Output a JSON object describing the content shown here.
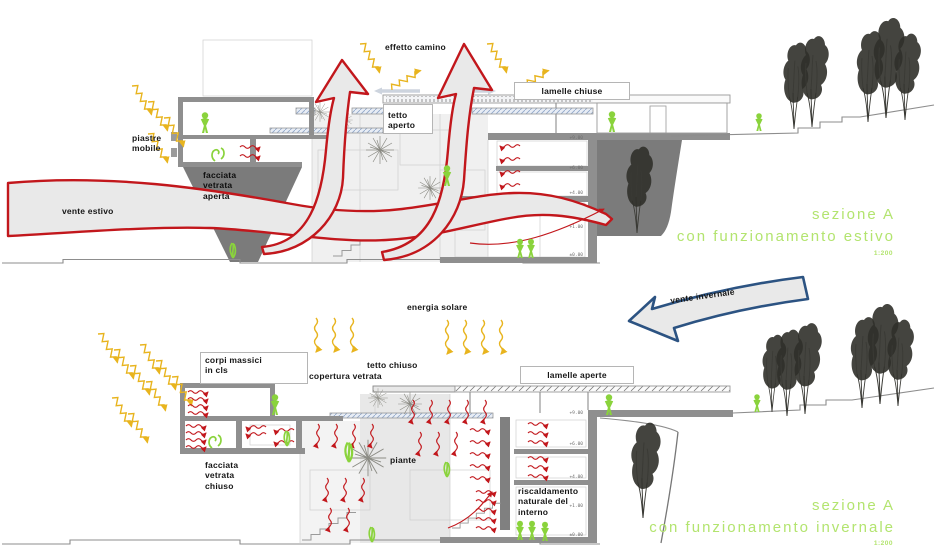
{
  "diagram": {
    "summer": {
      "title_line1": "sezione A",
      "title_line2": "con funzionamento estivo",
      "scale": "1:200",
      "labels": {
        "effetto_camino": "effetto camino",
        "lamelle_chiuse": "lamelle chiuse",
        "tetto_aperto": "tetto\naperto",
        "piastre_mobile": "piastre\nmobile",
        "facciata_vetrata_aperta": "facciata\nvetrata\naperta",
        "vente_estivo": "vente estivo"
      },
      "levels": [
        "+9.00",
        "+6.00",
        "+4.00",
        "+1.00",
        "±0.00"
      ]
    },
    "winter": {
      "title_line1": "sezione A",
      "title_line2": "con funzionamento invernale",
      "scale": "1:200",
      "labels": {
        "energia_solare": "energia solare",
        "tetto_chiuso": "tetto chiuso",
        "copertura_vetrata": "copertura vetrata",
        "corpi_massici": "corpi massici\nin cls",
        "lamelle_aperte": "lamelle aperte",
        "facciata_vetrata_chiuso": "facciata\nvetrata\nchiuso",
        "piante": "piante",
        "riscaldamento": "riscaldamento\nnaturale del\ninterno",
        "vente_invernale": "vente invernale"
      },
      "levels": [
        "+9.00",
        "+6.00",
        "+4.00",
        "+1.00",
        "±0.00"
      ]
    },
    "colors": {
      "flow_red": "#c2171c",
      "sun_yellow": "#e8b41e",
      "eco_green": "#b3e46f",
      "wind_blue": "#2c5382",
      "wall_gray": "#8a8a8a"
    }
  }
}
